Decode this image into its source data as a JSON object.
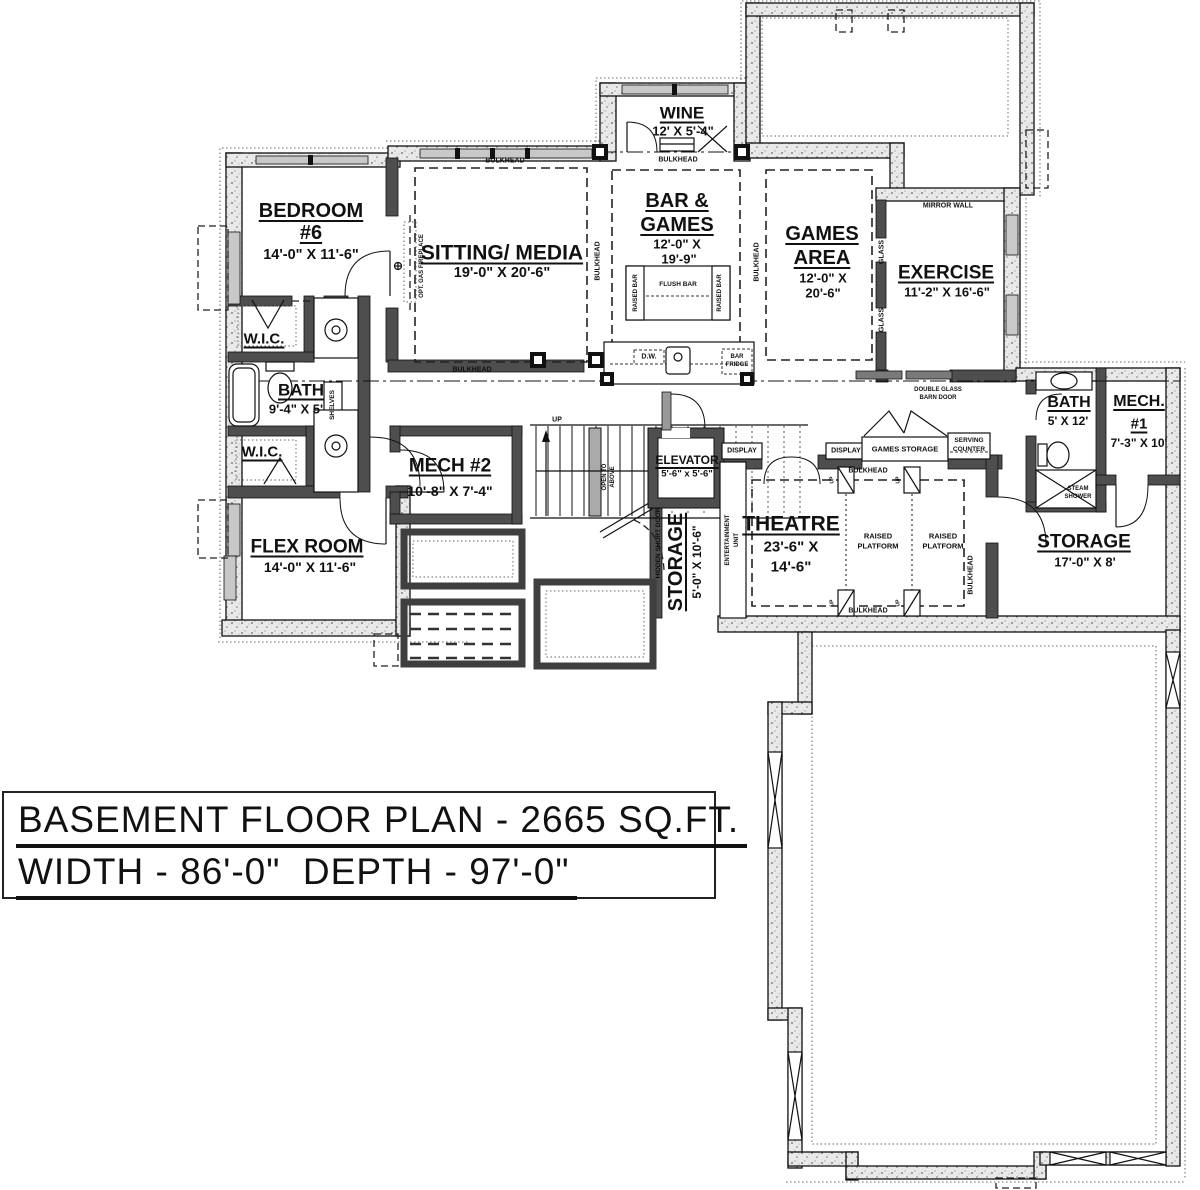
{
  "colors": {
    "ink": "#111111",
    "wall_gray": "#4e4e4e",
    "paper": "#ffffff"
  },
  "title_block": {
    "line1": "BASEMENT FLOOR PLAN - 2665 SQ.FT.",
    "line2": "WIDTH - 86'-0\"  DEPTH - 97'-0\""
  },
  "rooms": {
    "bedroom6": {
      "name": "BEDROOM",
      "number": "#6",
      "dims": "14'-0\" X 11'-6\""
    },
    "sitting_media": {
      "name": "SITTING/ MEDIA",
      "dims": "19'-0\" X 20'-6\""
    },
    "wine": {
      "name": "WINE",
      "dims": "12' X 5'-4\""
    },
    "bar_games": {
      "name_line1": "BAR &",
      "name_line2": "GAMES",
      "dims_line1": "12'-0\" X",
      "dims_line2": "19'-9\""
    },
    "games_area": {
      "name_line1": "GAMES",
      "name_line2": "AREA",
      "dims_line1": "12'-0\" X",
      "dims_line2": "20'-6\""
    },
    "exercise": {
      "name": "EXERCISE",
      "dims": "11'-2\" X 16'-6\""
    },
    "wic_upper": {
      "name": "W.I.C."
    },
    "bath_main": {
      "name": "BATH",
      "dims": "9'-4\" X 5'"
    },
    "wic_lower": {
      "name": "W.I.C."
    },
    "flex_room": {
      "name": "FLEX ROOM",
      "dims": "14'-0\" X 11'-6\""
    },
    "mech2": {
      "name": "MECH #2",
      "dims": "10'-8\" X 7'-4\""
    },
    "elevator": {
      "name": "ELEVATOR",
      "dims": "5'-6\" x 5'-6\""
    },
    "storage_small": {
      "name": "STORAGE",
      "dims": "5'-0\" X 10'-6\""
    },
    "theatre": {
      "name": "THEATRE",
      "dims_line1": "23'-6\" X",
      "dims_line2": "14'-6\""
    },
    "bath_small": {
      "name": "BATH",
      "dims": "5' X 12'"
    },
    "mech1": {
      "name": "MECH.",
      "number": "#1",
      "dims": "7'-3\" X 10'"
    },
    "storage_right": {
      "name": "STORAGE",
      "dims": "17'-0\" X 8'"
    }
  },
  "annotations": {
    "bulkhead": "BULKHEAD",
    "mirror_wall": "MIRROR WALL",
    "glass": "GLASS",
    "double_glass_barn_door_line1": "DOUBLE GLASS",
    "double_glass_barn_door_line2": "BARN DOOR",
    "raised_bar": "RAISED BAR",
    "flush_bar": "FLUSH BAR",
    "dishwasher": "D.W.",
    "bar_fridge_line1": "BAR",
    "bar_fridge_line2": "FRIDGE",
    "display": "DISPLAY",
    "games_storage": "GAMES STORAGE",
    "serving_counter_line1": "SERVING",
    "serving_counter_line2": "COUNTER",
    "raised_platform_line1": "RAISED",
    "raised_platform_line2": "PLATFORM",
    "entertainment_unit_line1": "ENTERTAINMENT",
    "entertainment_unit_line2": "UNIT",
    "hidden_short_door": "HIDDEN SHORT DOOR",
    "open_to_above_line1": "OPEN TO",
    "open_to_above_line2": "ABOVE",
    "up": "UP",
    "steam_shower_line1": "STEAM",
    "steam_shower_line2": "SHOWER",
    "shelves": "SHELVES",
    "opt_gas_fireplace": "OPT. GAS FIREPLACE"
  }
}
